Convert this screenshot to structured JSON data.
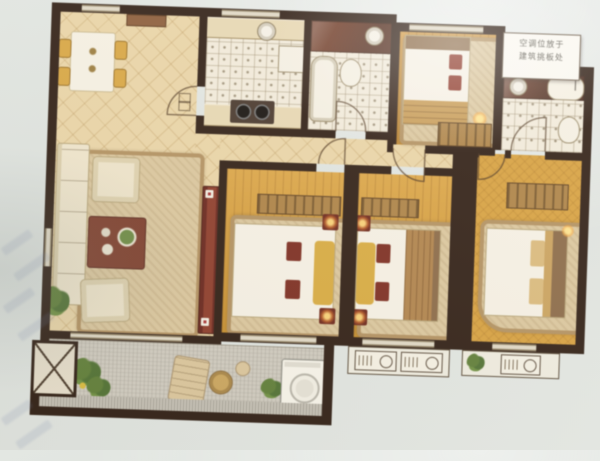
{
  "image_type": "photo-of-apartment-floor-plan",
  "annotation_note": {
    "line1": "空调位放于",
    "line2": "建筑挑板处"
  },
  "palette": {
    "photo_background": "#dfe3de",
    "wall": "#2f1d12",
    "warm_tile": "#e8d3a5",
    "white_tile": "#efe9da",
    "wood_floor": "#d49a33",
    "balcony_floor": "#cdc9bf",
    "accent_red_furniture": "#7e2e1f",
    "stone_counter": "#6e3823",
    "rug_border": "#b18f5e",
    "chair_gold": "#d8a43e"
  },
  "plan": {
    "rooms": [
      {
        "id": "dining-area",
        "floor": "warm-diagonal-tile",
        "furniture": [
          "dining-table",
          "four-gold-chairs",
          "sideboard"
        ]
      },
      {
        "id": "kitchen",
        "floor": "white-grid-tile",
        "furniture": [
          "counter-top",
          "round-sink",
          "two-burner-stove",
          "fridge",
          "counter-bottom"
        ]
      },
      {
        "id": "bathroom-1",
        "floor": "white-grid-tile",
        "furniture": [
          "stone-vanity",
          "round-sink",
          "bathtub",
          "toilet"
        ]
      },
      {
        "id": "bedroom-top",
        "floor": "wood-plank",
        "furniture": [
          "double-bed",
          "red-pillows",
          "area-rug",
          "striped-dresser",
          "bedside-lamp"
        ]
      },
      {
        "id": "bathroom-2",
        "floor": "white-grid-tile",
        "furniture": [
          "stone-vanity",
          "round-sink",
          "tub",
          "toilet"
        ]
      },
      {
        "id": "living-room",
        "floor": "warm-diagonal-tile",
        "furniture": [
          "l-sofa",
          "two-armchairs",
          "red-coffee-table",
          "patterned-rug",
          "floor-lamp",
          "plant",
          "red-tv-cabinet"
        ]
      },
      {
        "id": "bedroom-left",
        "floor": "wood-plank",
        "furniture": [
          "double-bed",
          "yellow-bolster",
          "red-pillows",
          "area-rug",
          "striped-wardrobe",
          "two-corner-lamps"
        ]
      },
      {
        "id": "bedroom-middle",
        "floor": "wood-plank",
        "furniture": [
          "double-bed",
          "yellow-bolster",
          "red-pillows",
          "area-rug",
          "striped-wardrobe",
          "two-corner-lamps"
        ]
      },
      {
        "id": "bedroom-right",
        "floor": "wood-diagonal-weave",
        "furniture": [
          "double-bed",
          "tan-pillows",
          "rounded-area-rug",
          "striped-wardrobe"
        ]
      },
      {
        "id": "hallway",
        "floor": "warm-diagonal-tile",
        "furniture": []
      },
      {
        "id": "balcony",
        "floor": "grey-stone-tile",
        "furniture": [
          "washing-machine",
          "lounge-chair",
          "round-table",
          "stool",
          "plants"
        ]
      }
    ],
    "exterior": {
      "ac_platforms": 2,
      "ac_outdoor_units": 3,
      "shaft_x_box": 1,
      "door_arcs": 6,
      "windows": 9
    }
  }
}
